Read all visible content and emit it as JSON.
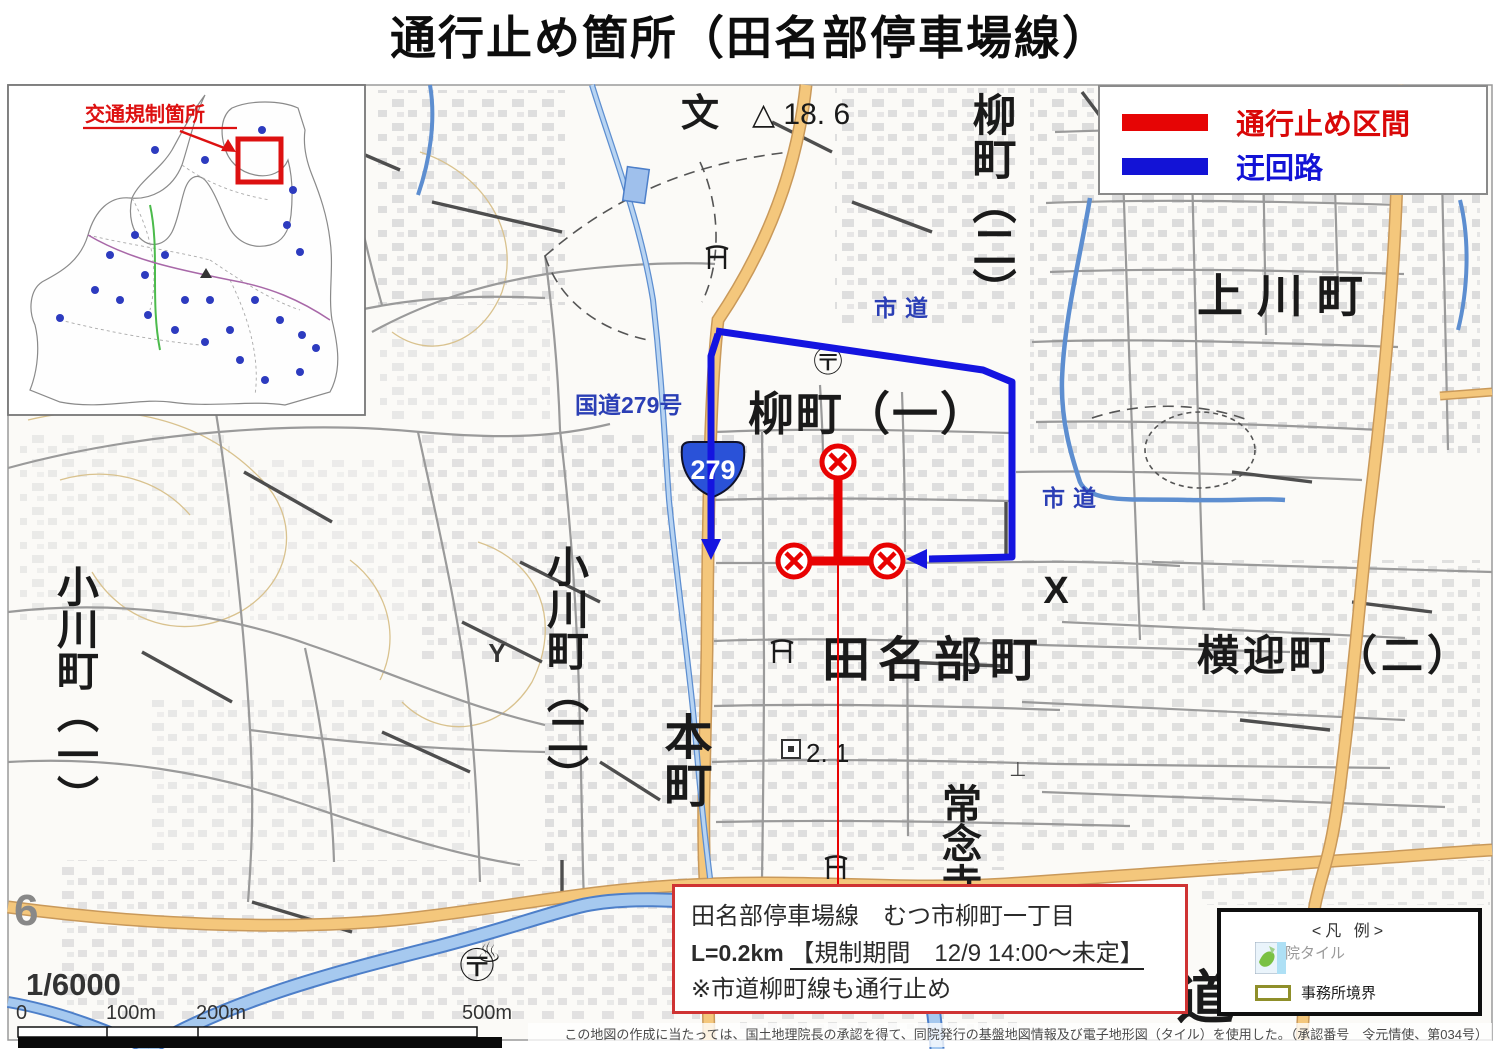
{
  "title": "通行止め箇所（田名部停車場線）",
  "colors": {
    "closed": "#e60505",
    "detour": "#1313d6",
    "major_road": "#f4c77c",
    "river": "#a6c9ef"
  },
  "route_legend": {
    "closed": "通行止め区間",
    "detour": "迂回路"
  },
  "inset": {
    "caption": "交通規制箇所"
  },
  "shield": {
    "number": "279"
  },
  "labels": {
    "yanagimachi2": "柳町（二）",
    "kamikawa": "上川町",
    "yanagimachi1": "柳町（一）",
    "shido_top": "市道",
    "shido_right": "市道",
    "kokudo279": "国道279号",
    "ogawa1": "小川町（一）",
    "ogawa2": "小川町（二）",
    "honcho": "本町",
    "tanabu": "田名部町",
    "jonenji": "常念寺",
    "yokomukae": "横迎町（二）",
    "x_mark": "X",
    "school": "文",
    "elevation": "△ 18. 6",
    "benchmark": "2. 1",
    "tile_no": "6",
    "michi": "道",
    "onsen": "♨",
    "y_mark": "Y",
    "grave": "⊥",
    "post_top": "〶",
    "post_bottom": "〶"
  },
  "info_box": {
    "line1": "田名部停車場線　むつ市柳町一丁目",
    "line2_prefix": "L=0.2km",
    "line2_underline": "【規制期間　12/9 14:00～未定】",
    "line3": "※市道柳町線も通行止め"
  },
  "map_legend": {
    "title": "<凡 例>",
    "tile_label": "地理院タイル",
    "boundary_label": "事務所境界"
  },
  "scale": {
    "ratio": "1/6000",
    "tick0": "0",
    "tick100": "100m",
    "tick200": "200m",
    "tick500": "500m"
  },
  "attribution": "この地図の作成に当たっては、国土地理院長の承認を得て、同院発行の基盤地図情報及び電子地形図（タイル）を使用した。（承認番号　令元情使、第034号）"
}
